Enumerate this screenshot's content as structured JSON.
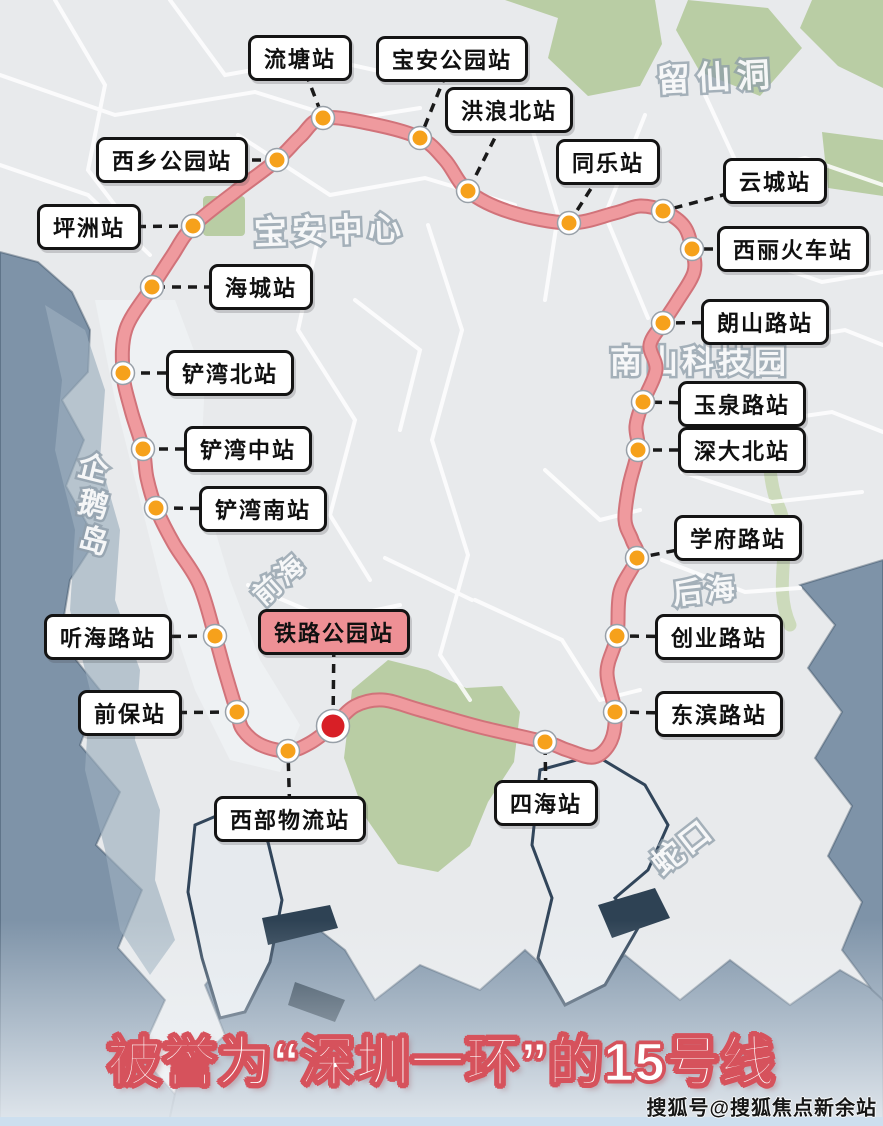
{
  "title": {
    "text": "被誉为“深圳一环”的15号线"
  },
  "watermark": {
    "text": "搜狐号@搜狐焦点新余站"
  },
  "colors": {
    "line": "#ef9a9e",
    "line_border": "#d1737a",
    "dot": "#f6a11b",
    "dot_ring": "#ffffff",
    "dot_edge": "#98a0a8",
    "dot_highlight": "#d81f26",
    "connector": "#1a1a1a",
    "label_bg": "#ffffff",
    "label_highlight_bg": "#ee9095",
    "title_outline": "#d6525c",
    "water": "#7e93a8",
    "green": "#b9cda4"
  },
  "map": {
    "stations": [
      {
        "name": "流塘站",
        "dot": [
          323,
          118
        ],
        "label": [
          300,
          58
        ],
        "highlight": false
      },
      {
        "name": "宝安公园站",
        "dot": [
          420,
          138
        ],
        "label": [
          452,
          59
        ],
        "highlight": false
      },
      {
        "name": "洪浪北站",
        "dot": [
          468,
          191
        ],
        "label": [
          509,
          110
        ],
        "highlight": false
      },
      {
        "name": "同乐站",
        "dot": [
          569,
          223
        ],
        "label": [
          608,
          162
        ],
        "highlight": false
      },
      {
        "name": "云城站",
        "dot": [
          663,
          211
        ],
        "label": [
          775,
          181
        ],
        "highlight": false
      },
      {
        "name": "西丽火车站",
        "dot": [
          692,
          249
        ],
        "label": [
          793,
          249
        ],
        "highlight": false
      },
      {
        "name": "朗山路站",
        "dot": [
          663,
          323
        ],
        "label": [
          765,
          322
        ],
        "highlight": false
      },
      {
        "name": "玉泉路站",
        "dot": [
          643,
          402
        ],
        "label": [
          742,
          404
        ],
        "highlight": false
      },
      {
        "name": "深大北站",
        "dot": [
          638,
          450
        ],
        "label": [
          742,
          450
        ],
        "highlight": false
      },
      {
        "name": "学府路站",
        "dot": [
          637,
          558
        ],
        "label": [
          738,
          538
        ],
        "highlight": false
      },
      {
        "name": "创业路站",
        "dot": [
          617,
          636
        ],
        "label": [
          719,
          637
        ],
        "highlight": false
      },
      {
        "name": "东滨路站",
        "dot": [
          615,
          712
        ],
        "label": [
          719,
          714
        ],
        "highlight": false
      },
      {
        "name": "四海站",
        "dot": [
          545,
          742
        ],
        "label": [
          546,
          803
        ],
        "highlight": false
      },
      {
        "name": "铁路公园站",
        "dot": [
          333,
          726
        ],
        "label": [
          334,
          632
        ],
        "highlight": true
      },
      {
        "name": "西部物流站",
        "dot": [
          288,
          751
        ],
        "label": [
          290,
          819
        ],
        "highlight": false
      },
      {
        "name": "前保站",
        "dot": [
          237,
          712
        ],
        "label": [
          130,
          713
        ],
        "highlight": false
      },
      {
        "name": "听海路站",
        "dot": [
          215,
          636
        ],
        "label": [
          108,
          637
        ],
        "highlight": false
      },
      {
        "name": "铲湾南站",
        "dot": [
          156,
          508
        ],
        "label": [
          263,
          509
        ],
        "highlight": false
      },
      {
        "name": "铲湾中站",
        "dot": [
          143,
          449
        ],
        "label": [
          248,
          449
        ],
        "highlight": false
      },
      {
        "name": "铲湾北站",
        "dot": [
          123,
          373
        ],
        "label": [
          230,
          373
        ],
        "highlight": false
      },
      {
        "name": "海城站",
        "dot": [
          152,
          287
        ],
        "label": [
          261,
          287
        ],
        "highlight": false
      },
      {
        "name": "坪洲站",
        "dot": [
          193,
          226
        ],
        "label": [
          89,
          227
        ],
        "highlight": false
      },
      {
        "name": "西乡公园站",
        "dot": [
          277,
          160
        ],
        "label": [
          172,
          160
        ],
        "highlight": false
      }
    ],
    "line": {
      "points": [
        [
          323,
          118
        ],
        [
          372,
          124
        ],
        [
          420,
          138
        ],
        [
          445,
          160
        ],
        [
          468,
          191
        ],
        [
          510,
          212
        ],
        [
          569,
          223
        ],
        [
          615,
          213
        ],
        [
          640,
          206
        ],
        [
          663,
          211
        ],
        [
          684,
          226
        ],
        [
          692,
          249
        ],
        [
          694,
          272
        ],
        [
          678,
          300
        ],
        [
          663,
          323
        ],
        [
          650,
          345
        ],
        [
          656,
          370
        ],
        [
          643,
          402
        ],
        [
          636,
          426
        ],
        [
          638,
          450
        ],
        [
          629,
          486
        ],
        [
          625,
          520
        ],
        [
          632,
          540
        ],
        [
          637,
          558
        ],
        [
          620,
          592
        ],
        [
          617,
          636
        ],
        [
          607,
          672
        ],
        [
          615,
          712
        ],
        [
          611,
          741
        ],
        [
          594,
          757
        ],
        [
          567,
          750
        ],
        [
          545,
          742
        ],
        [
          480,
          727
        ],
        [
          420,
          710
        ],
        [
          383,
          700
        ],
        [
          355,
          706
        ],
        [
          333,
          726
        ],
        [
          310,
          743
        ],
        [
          288,
          751
        ],
        [
          261,
          745
        ],
        [
          243,
          730
        ],
        [
          237,
          712
        ],
        [
          225,
          672
        ],
        [
          215,
          636
        ],
        [
          199,
          584
        ],
        [
          174,
          544
        ],
        [
          156,
          508
        ],
        [
          147,
          478
        ],
        [
          143,
          449
        ],
        [
          131,
          410
        ],
        [
          123,
          373
        ],
        [
          126,
          329
        ],
        [
          152,
          287
        ],
        [
          172,
          256
        ],
        [
          193,
          226
        ],
        [
          235,
          192
        ],
        [
          277,
          160
        ],
        [
          300,
          137
        ]
      ]
    },
    "areas": [
      {
        "name": "宝安中心",
        "x": 330,
        "y": 233,
        "rot": -2,
        "size": 33,
        "ls": 5,
        "vertical": false
      },
      {
        "name": "留仙洞",
        "x": 717,
        "y": 80,
        "rot": -3,
        "size": 33,
        "ls": 7,
        "vertical": false
      },
      {
        "name": "南山科技园",
        "x": 700,
        "y": 364,
        "rot": 0,
        "size": 32,
        "ls": 4,
        "vertical": false
      },
      {
        "name": "前海",
        "x": 281,
        "y": 581,
        "rot": -42,
        "size": 27,
        "ls": 3,
        "vertical": false
      },
      {
        "name": "后海",
        "x": 706,
        "y": 593,
        "rot": -6,
        "size": 29,
        "ls": 4,
        "vertical": false
      },
      {
        "name": "企鹅岛",
        "x": 86,
        "y": 505,
        "rot": 14,
        "size": 30,
        "ls": 4,
        "vertical": true
      },
      {
        "name": "蛇口",
        "x": 684,
        "y": 849,
        "rot": -38,
        "size": 31,
        "ls": 3,
        "vertical": false
      }
    ]
  }
}
